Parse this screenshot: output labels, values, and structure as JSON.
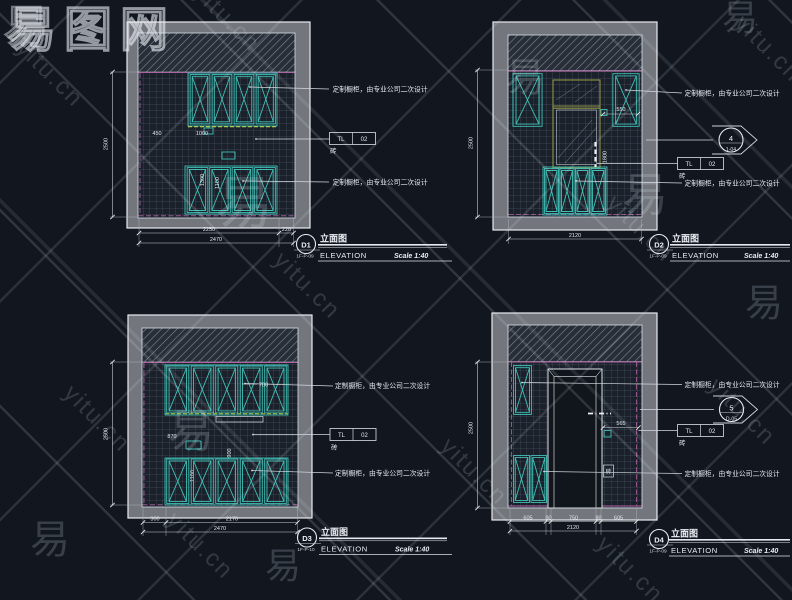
{
  "watermark": {
    "site": "yitu.cn",
    "char": "易",
    "logo": "易图网"
  },
  "shared": {
    "cabinet_note": "定制橱柜，由专业公司二次设计",
    "tag_tl": "TL",
    "tag_num": "02",
    "tag_material": "砖",
    "title_cn": "立面图",
    "title_en": "ELEVATION",
    "scale": "Scale 1:40"
  },
  "panels": {
    "d1": {
      "id": "D1",
      "sheet": "1F-P-09",
      "dim_height": "2500",
      "dim_b1": "2250",
      "dim_b2": "220",
      "dim_total": "2470",
      "dim_upper_left": "450",
      "dim_upper": "1000",
      "dim_mid": "1300",
      "dim_lower": "1100"
    },
    "d2": {
      "id": "D2",
      "sheet": "1F-P-09",
      "dim_height": "2500",
      "dim_total": "2120",
      "dim_right": "550",
      "dim_mirror": "1800",
      "marker_num": "4",
      "marker_ref": "1-04"
    },
    "d3": {
      "id": "D3",
      "sheet": "1F-P-10",
      "dim_height": "2500",
      "dim_b1": "300",
      "dim_b2": "2170",
      "dim_total": "2470",
      "dim_upper": "700",
      "dim_mid": "870",
      "dim_center": "900",
      "dim_lower": "1100"
    },
    "d4": {
      "id": "D4",
      "sheet": "1F-P-09",
      "dim_height": "2500",
      "dim_b1": "605",
      "dim_b2": "80",
      "dim_b3": "750",
      "dim_b4": "80",
      "dim_b5": "605",
      "dim_total": "2120",
      "dim_niche": "565",
      "marker_num": "5",
      "marker_ref": "D-05"
    }
  }
}
